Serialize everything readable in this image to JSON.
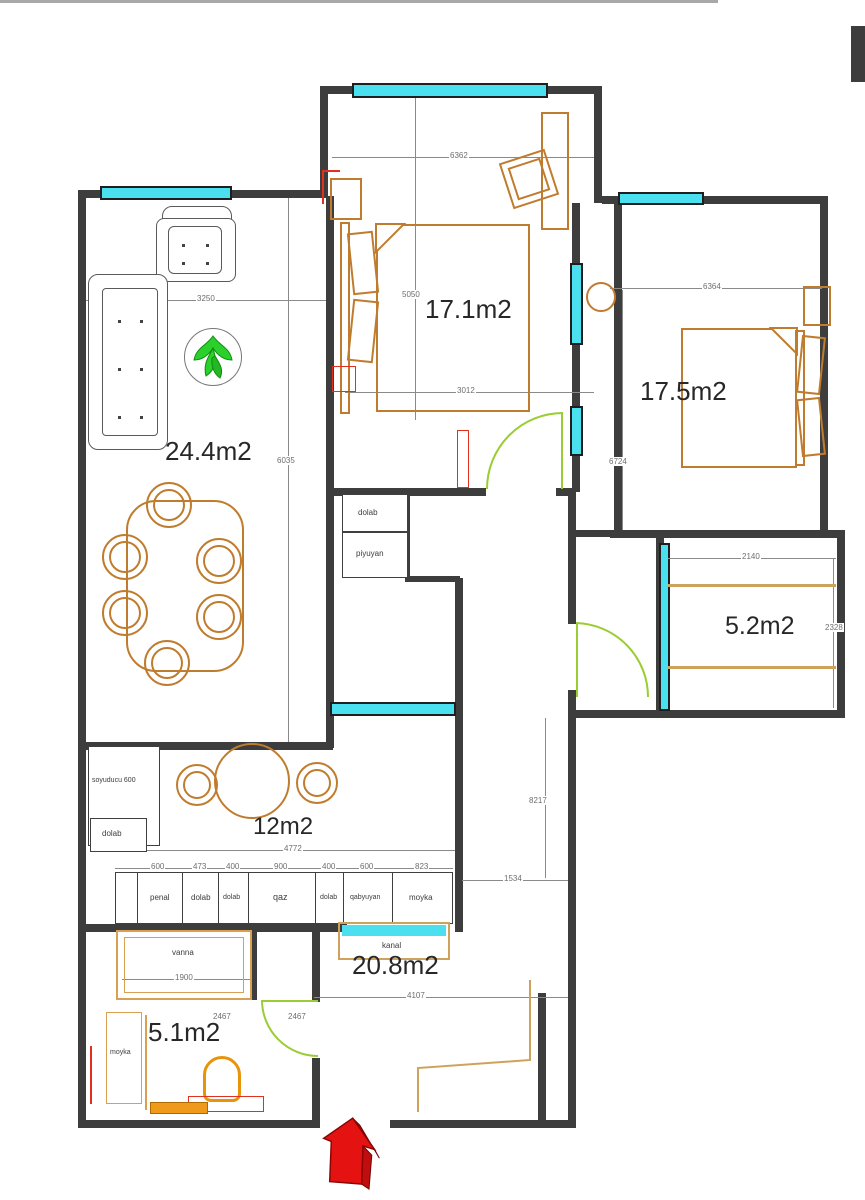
{
  "plan": {
    "rooms": [
      {
        "name": "bedroom-top",
        "area": "17.1m2"
      },
      {
        "name": "bedroom-right",
        "area": "17.5m2"
      },
      {
        "name": "living-room",
        "area": "24.4m2"
      },
      {
        "name": "balcony",
        "area": "5.2m2"
      },
      {
        "name": "kitchen",
        "area": "12m2"
      },
      {
        "name": "hallway",
        "area": "20.8m2"
      },
      {
        "name": "bathroom",
        "area": "5.1m2"
      }
    ],
    "fixtures": {
      "hall_closet": "dolab",
      "hall_washstand": "piyuyan",
      "fridge": "soyuducu 600",
      "kitchen_closet": "dolab",
      "duct": "kanal",
      "bathtub": "vanna",
      "bath_sink": "moyka"
    },
    "cabinets": [
      {
        "label": "penal",
        "width": "600"
      },
      {
        "label": "dolab",
        "width": "473"
      },
      {
        "label": "dolab",
        "width": "400"
      },
      {
        "label": "qaz",
        "width": "900"
      },
      {
        "label": "dolab",
        "width": "400"
      },
      {
        "label": "qabyuyan",
        "width": "600"
      },
      {
        "label": "moyka",
        "width": "823"
      }
    ],
    "dimensions": {
      "bed1_top": "6362",
      "bed1_h": "5050",
      "bed1_w": "3012",
      "bed2_top": "6364",
      "bed2_h": "6724",
      "living_w": "3250",
      "living_h": "6035",
      "balcony_w": "2140",
      "balcony_h": "2328",
      "hall_h": "8217",
      "pass_w": "1534",
      "kitchen_w": "4772",
      "hall_w": "4107",
      "bathtub_w": "1900",
      "bath_d1": "2467",
      "bath_d2": "2467"
    },
    "colors": {
      "wall": "#3d3d3d",
      "furniture": "#c07c2e",
      "window": "#4ae0ef",
      "door": "#9acd32",
      "accent": "#e03020",
      "logo": "#2bd12b"
    }
  }
}
